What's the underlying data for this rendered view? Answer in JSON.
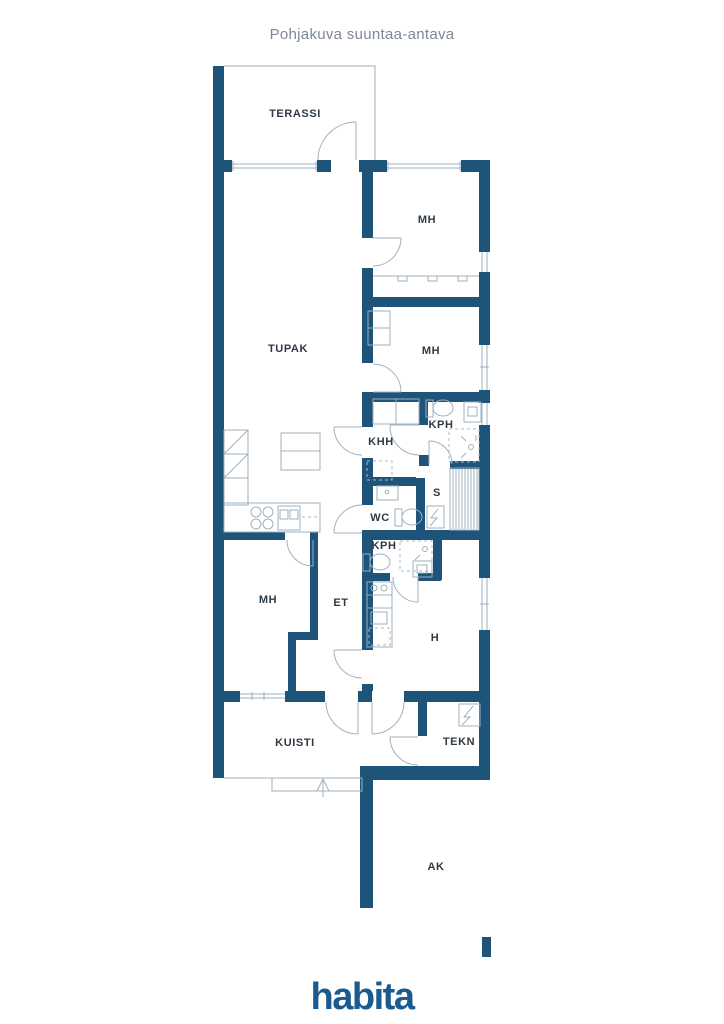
{
  "title": "Pohjakuva suuntaa-antava",
  "rooms": {
    "terassi": "TERASSI",
    "mh_top": "MH",
    "mh_mid": "MH",
    "tupak": "TUPAK",
    "khh": "KHH",
    "kph_top": "KPH",
    "s": "S",
    "wc": "WC",
    "kph_bottom": "KPH",
    "mh_bottom": "MH",
    "et": "ET",
    "h": "H",
    "kuisti": "KUISTI",
    "tekn": "TEKN",
    "ak": "AK"
  },
  "branding": {
    "logo_text": "habita",
    "logo_color": "#1a5a8e"
  },
  "colors": {
    "wall": "#1e547a",
    "thin_line": "#9fb1bf",
    "label": "#2f3a44",
    "title": "#7e8893"
  }
}
